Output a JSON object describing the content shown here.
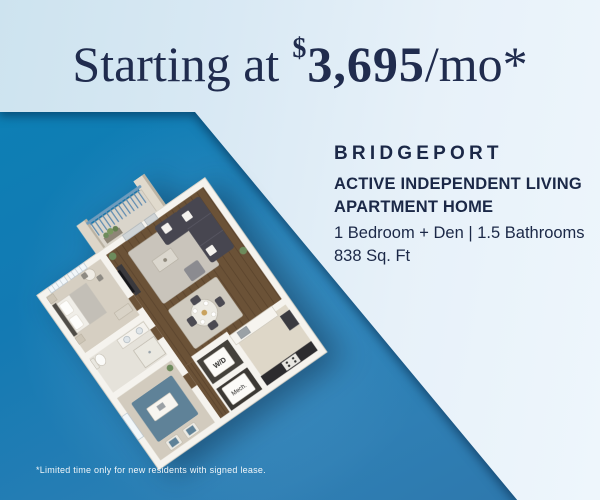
{
  "header": {
    "prefix": "Starting at",
    "currency_symbol": "$",
    "price": "3,695",
    "per": "/mo*"
  },
  "unit": {
    "name": "BRIDGEPORT",
    "program_line1": "ACTIVE INDEPENDENT LIVING",
    "program_line2": "APARTMENT HOME",
    "layout": "1 Bedroom + Den | 1.5 Bathrooms",
    "area": "838 Sq. Ft"
  },
  "floorplan": {
    "washer_dryer": "W/D",
    "mechanical": "Mech."
  },
  "footer": {
    "disclaimer": "*Limited time only for new residents with signed lease."
  },
  "colors": {
    "navy_text": "#1b2847",
    "headline_navy": "#202c4e",
    "blue_field_start": "#0a82b6",
    "blue_field_end": "#2d76ab",
    "light_band_start": "#cde3ef",
    "light_band_end": "#eef6fc",
    "disclaimer_text": "#ffffff",
    "wood_floor": "#6b5237",
    "carpet": "#d6cfc2",
    "railing_blue": "#5f8cb0"
  }
}
